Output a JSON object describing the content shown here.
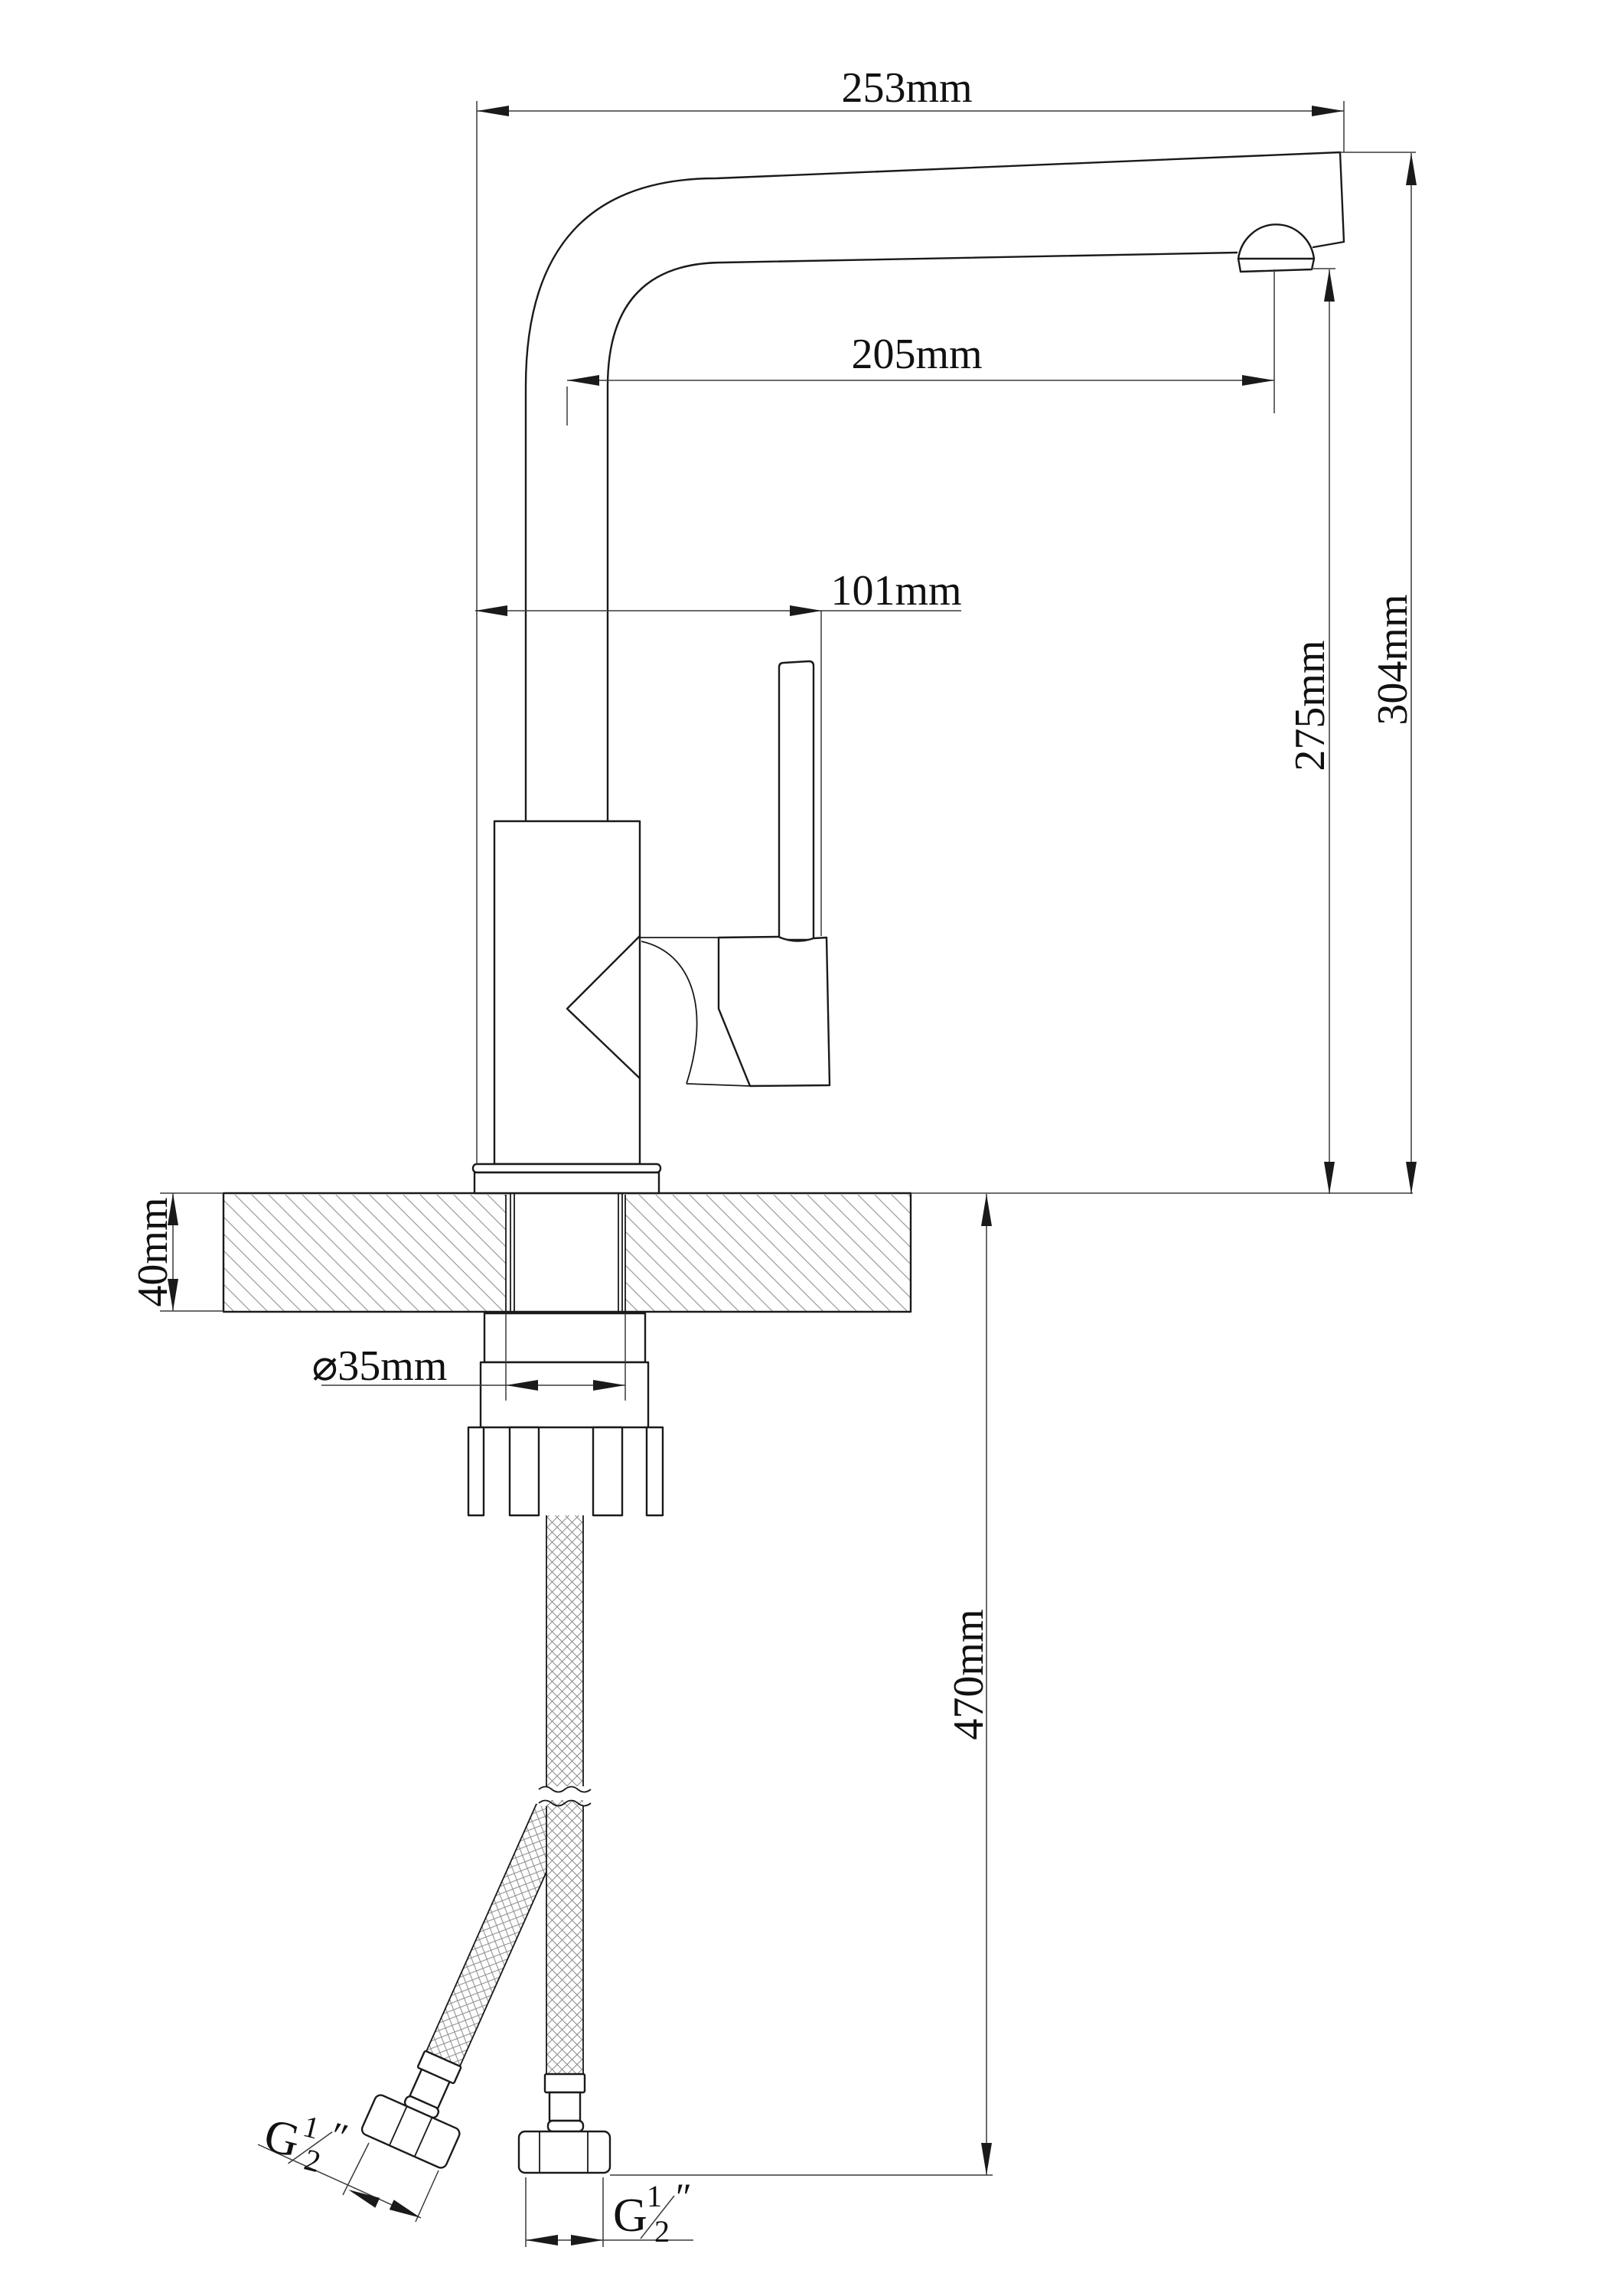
{
  "drawing": {
    "type": "technical-drawing",
    "subject": "single-lever high-arc kitchen faucet, side elevation with installation dimensions",
    "background": "#ffffff",
    "line_color": "#1a1a1a",
    "dims": {
      "spout_total_reach": "253mm",
      "spout_reach_to_aerator": "205mm",
      "body_to_handle_width": "101mm",
      "spout_outlet_height": "275mm",
      "total_height_above_counter": "304mm",
      "counter_thickness": "40mm",
      "mounting_hole_diameter": "⌀35mm",
      "supply_hose_length": "470mm"
    },
    "threads": {
      "left": {
        "prefix": "G",
        "numerator": "1",
        "denominator": "2",
        "unit": "″"
      },
      "bottom": {
        "prefix": "G",
        "numerator": "1",
        "denominator": "2",
        "unit": "″"
      }
    }
  }
}
